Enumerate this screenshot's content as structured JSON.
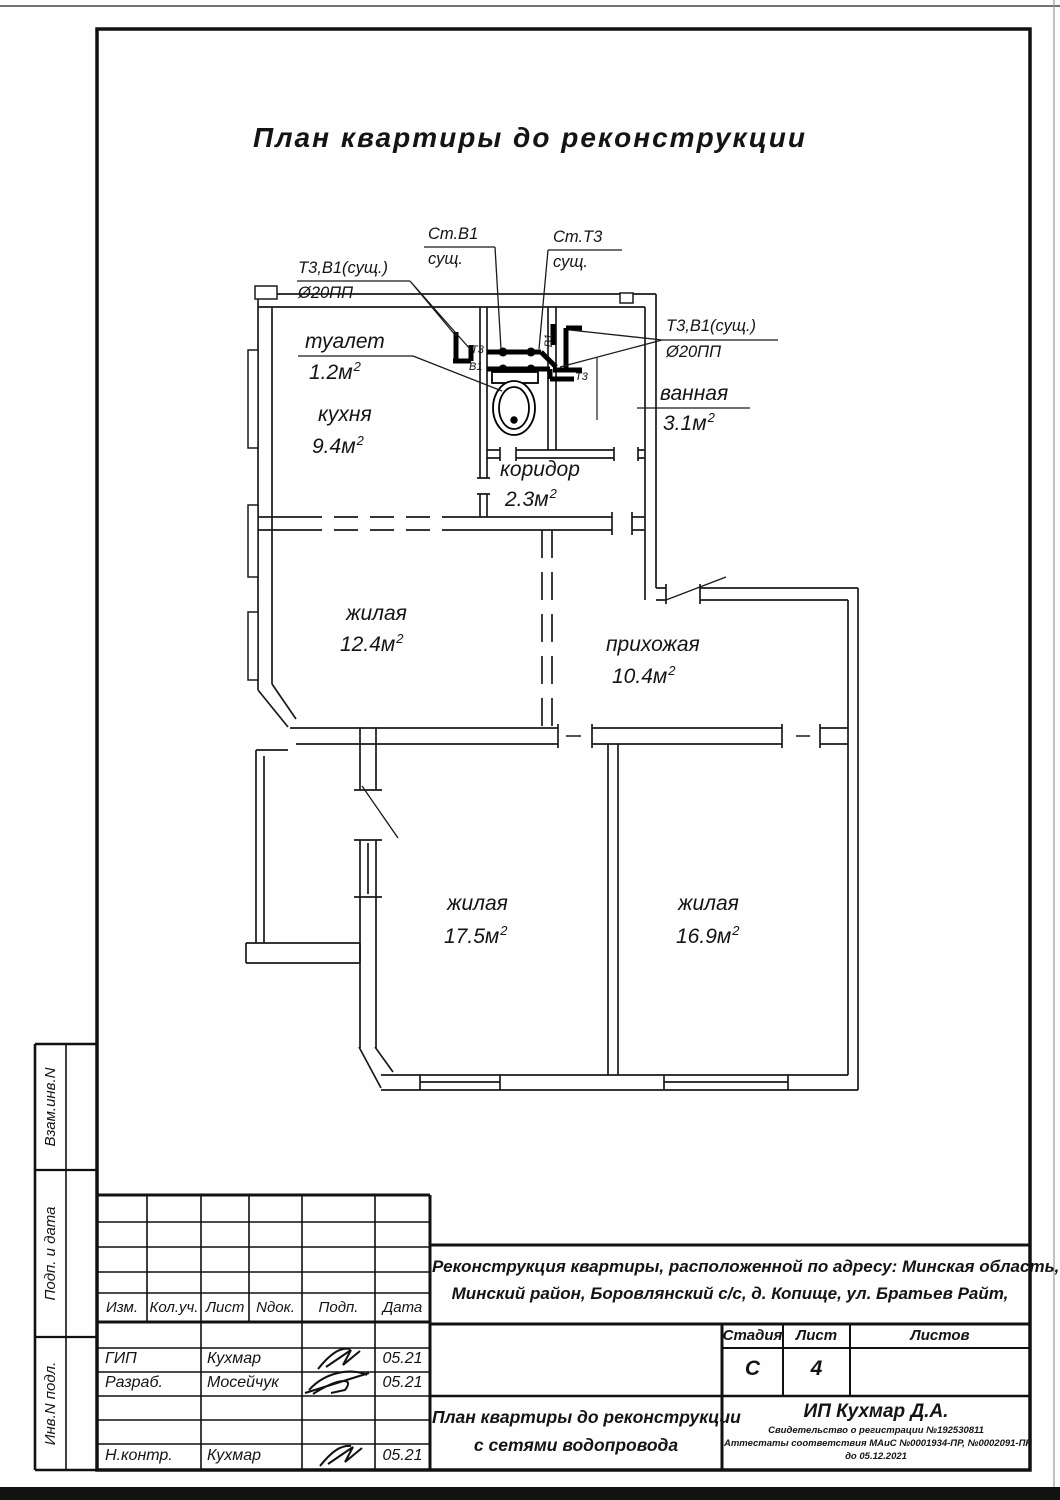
{
  "sheet": {
    "title": "План квартиры до реконструкции",
    "side_labels": [
      "Взам.инв.N",
      "Подп. и дата",
      "Инв.N подл."
    ]
  },
  "plan": {
    "sup": "2",
    "rooms": [
      {
        "name": "туалет",
        "area": "1.2м"
      },
      {
        "name": "кухня",
        "area": "9.4м"
      },
      {
        "name": "ванная",
        "area": "3.1м"
      },
      {
        "name": "коридор",
        "area": "2.3м"
      },
      {
        "name": "жилая",
        "area": "12.4м"
      },
      {
        "name": "прихожая",
        "area": "10.4м"
      },
      {
        "name": "жилая",
        "area": "17.5м"
      },
      {
        "name": "жилая",
        "area": "16.9м"
      }
    ],
    "annotations": {
      "riser_v1": {
        "line1": "Ст.В1",
        "line2": "сущ."
      },
      "riser_t3": {
        "line1": "Ст.Т3",
        "line2": "сущ."
      },
      "pipes_left": {
        "line1": "Т3,В1(сущ.)",
        "line2": "Ø20ПП"
      },
      "pipes_right": {
        "line1": "Т3,В1(сущ.)",
        "line2": "Ø20ПП"
      },
      "pipe_tags": {
        "t3": "Т3",
        "v1": "В1"
      }
    }
  },
  "titleblock": {
    "columns": [
      "Изм.",
      "Кол.уч.",
      "Лист",
      "Nдок.",
      "Подп.",
      "Дата"
    ],
    "rows": [
      {
        "role": "ГИП",
        "name": "Кухмар",
        "date": "05.21"
      },
      {
        "role": "Разраб.",
        "name": "Мосейчук",
        "date": "05.21"
      },
      {
        "role": "Н.контр.",
        "name": "Кухмар",
        "date": "05.21"
      }
    ],
    "project_line1": "Реконструкция квартиры, расположенной по адресу: Минская область,",
    "project_line2": "Минский район, Боровлянский с/с, д. Копище, ул. Братьев Райт,",
    "stage_label": "Стадия",
    "sheet_label": "Лист",
    "sheets_label": "Листов",
    "stage_value": "С",
    "sheet_value": "4",
    "sheets_value": "",
    "doc_line1": "План квартиры до реконструкции",
    "doc_line2": "с сетями водопровода",
    "firm": "ИП Кухмар Д.А.",
    "cert_line1": "Свидетельство о регистрации №192530811",
    "cert_line2": "Аттестаты соответствия МАиС №0001934-ПР, №0002091-ПР",
    "cert_line3": "до 05.12.2021"
  }
}
